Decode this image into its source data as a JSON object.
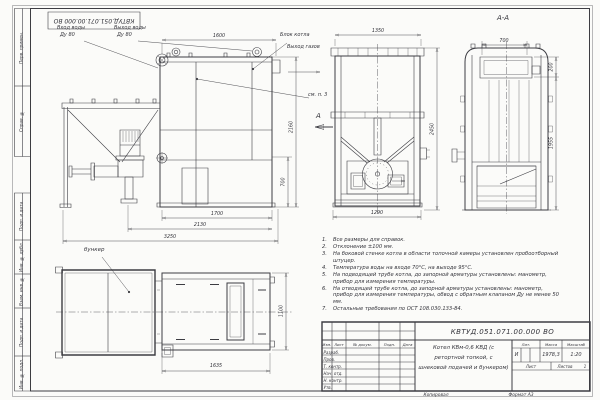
{
  "page": {
    "stamp_number": "КВТУД.051.071.00.000 ВО",
    "footer": {
      "copy": "Копировал",
      "format": "Формат А3"
    }
  },
  "margin": {
    "labels": [
      "Перв. примен.",
      "Справ. №",
      "Подп. и дата",
      "Инв. № дубл.",
      "Взам. инв. №",
      "Подп. и дата",
      "Инв. № подл."
    ]
  },
  "views": {
    "section_title": "А-А",
    "cut_label": "А",
    "bunker_label": "бункер"
  },
  "labels": {
    "water_in_1": "Вход воды",
    "water_in_2": "Ду 80",
    "water_out_1": "Выход воды",
    "water_out_2": "Ду 80",
    "boiler_block": "Блок котла",
    "gas_out": "Выход газов",
    "see_note": "см. п. 3"
  },
  "dims": {
    "top_1600": "1600",
    "front_1350": "1350",
    "sec_700": "700",
    "sec_200": "200",
    "sec_1955": "1955",
    "side_2160": "2160",
    "side_700": "700",
    "front_2450": "2450",
    "front_1290": "1290",
    "side_1700": "1700",
    "side_2130": "2130",
    "side_3250": "3250",
    "plan_1635": "1635",
    "plan_1100": "1100"
  },
  "notes": [
    {
      "n": "1.",
      "t": "Все размеры для справок."
    },
    {
      "n": "2.",
      "t": "Отклонение ±100 мм."
    },
    {
      "n": "3.",
      "t": "На боковой стенке котла в области топочной камеры установлен пробоотборный штуцер."
    },
    {
      "n": "4.",
      "t": "Температура воды на входе 70°С, на выходе 95°С."
    },
    {
      "n": "5.",
      "t": "На подводящей трубе котла, до запорной арматуры установлены: манометр, прибор для измерения температуры."
    },
    {
      "n": "6.",
      "t": "На отводящей трубе котла, до запорной арматуры установлены: манометр, прибор для измерения температуры, обвод с обратным клапаном Ду не менее 50 мм."
    },
    {
      "n": "7.",
      "t": "Остальные требования по ОСТ 108.030.133-84."
    }
  ],
  "title_block": {
    "doc_number": "КВТУД.051.071.00.000 ВО",
    "name_line1": "Котел КВм-0,6 КВД (с",
    "name_line2": "ретортной топкой, с",
    "name_line3": "шнековой подачей и бункером)",
    "cols": [
      "Изм.",
      "Лист",
      "№ докум.",
      "Подп.",
      "Дата"
    ],
    "rows": [
      "Разраб.",
      "Пров.",
      "Т. контр.",
      "Нач. отд.",
      "Н. контр.",
      "Утв."
    ],
    "lit_header": "Лит.",
    "lit_value": "И",
    "mass_header": "Масса",
    "mass_value": "1978,3",
    "scale_header": "Масштаб",
    "scale_value": "1:20",
    "sheet_header": "Лист",
    "sheets_header": "Листов",
    "sheets_value": "1"
  }
}
